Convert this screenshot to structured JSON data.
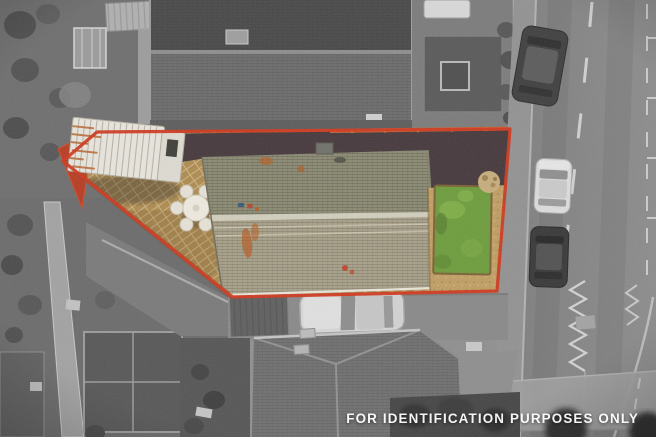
{
  "overlay": {
    "disclaimer": "FOR IDENTIFICATION PURPOSES ONLY"
  },
  "colors": {
    "boundary_red": "#d0381d",
    "corner_wall_red": "#bb3a20",
    "top_wall_orange": "#c4693a",
    "patio_tan": "#ae8b50",
    "drive_brown": "#45383c",
    "gravel_tan": "#c09e63",
    "lawn_green": "#6d9c3c",
    "roof_green_upper": "#8b8a73",
    "roof_ridge_light": "#d6d2c2",
    "roof_green_lower": "#a7a089",
    "caravan_white": "#e8e5dd",
    "rust_orange": "#b45f27"
  }
}
